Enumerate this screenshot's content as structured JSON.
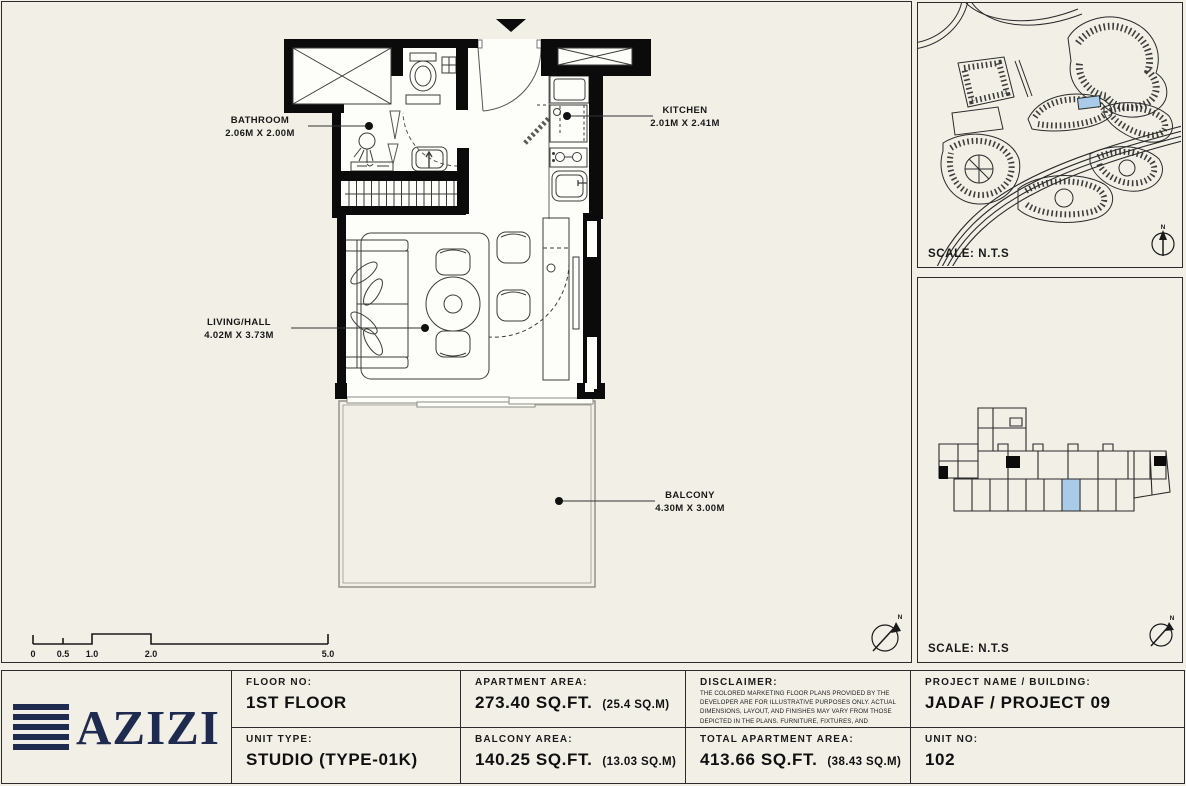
{
  "colors": {
    "background": "#f2efe7",
    "wall_black": "#0b0b0b",
    "brand_navy": "#1f2b4e",
    "unit_highlight_blue": "#a9cbe8",
    "border_dark": "#2b2b2b"
  },
  "floor_plan": {
    "rooms": [
      {
        "name": "BATHROOM",
        "dimensions": "2.06M X 2.00M"
      },
      {
        "name": "KITCHEN",
        "dimensions": "2.01M X 2.41M"
      },
      {
        "name": "LIVING/HALL",
        "dimensions": "4.02M X 3.73M"
      },
      {
        "name": "BALCONY",
        "dimensions": "4.30M X 3.00M"
      }
    ],
    "scale_bar_labels": [
      "0",
      "0.5",
      "1.0",
      "2.0",
      "5.0"
    ],
    "north_label": "N"
  },
  "site_map_panel": {
    "scale_label": "SCALE: N.T.S"
  },
  "key_plan_panel": {
    "scale_label": "SCALE: N.T.S"
  },
  "title_block": {
    "logo_text": "AZIZI",
    "floor_no": {
      "label": "FLOOR NO:",
      "value": "1ST FLOOR"
    },
    "unit_type": {
      "label": "UNIT TYPE:",
      "value": "STUDIO (TYPE-01K)"
    },
    "apartment_area": {
      "label": "APARTMENT AREA:",
      "value": "273.40 SQ.FT.",
      "metric": "(25.4 SQ.M)"
    },
    "balcony_area": {
      "label": "BALCONY AREA:",
      "value": "140.25 SQ.FT.",
      "metric": "(13.03 SQ.M)"
    },
    "disclaimer": {
      "label": "DISCLAIMER:",
      "text": "THE COLORED MARKETING FLOOR PLANS PROVIDED BY THE DEVELOPER ARE FOR ILLUSTRATIVE PURPOSES ONLY. ACTUAL DIMENSIONS, LAYOUT, AND FINISHES MAY VARY FROM THOSE DEPICTED IN THE PLANS. FURNITURE, FIXTURES, AND EQUIPMENT SHOWN IN THE PLANS ARE FOR DECORATIVE PURPOSES ONLY AND ARE NOT INCLUDED IN THE PURCHASE OR LEASE OF THE PROPERTY. THE DEVELOPER RESERVES THE RIGHT TO MAKE MODIFICATIONS, REVISIONS, AND CHANGES TO THE FLOOR PLANS, SPECIFICATIONS, AND FEATURES WITHOUT PRIOR NOTICE."
    },
    "total_area": {
      "label": "TOTAL APARTMENT AREA:",
      "value": "413.66 SQ.FT.",
      "metric": "(38.43 SQ.M)"
    },
    "project_name": {
      "label": "PROJECT NAME / BUILDING:",
      "value": "JADAF / PROJECT 09"
    },
    "unit_no": {
      "label": "UNIT NO:",
      "value": "102"
    }
  }
}
